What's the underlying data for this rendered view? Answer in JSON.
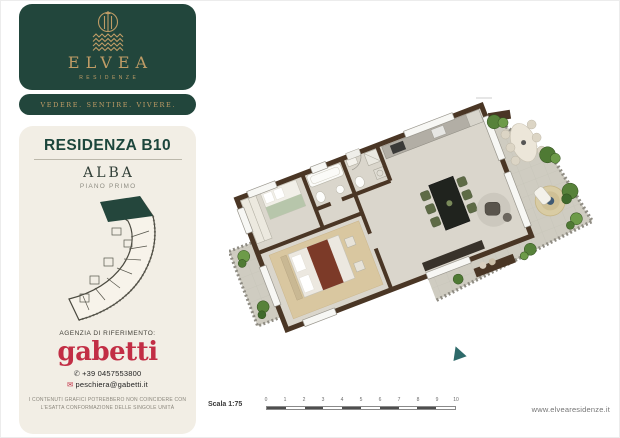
{
  "brand": {
    "name": "ELVEA",
    "subtitle": "RESIDENZE",
    "tagline": "VEDERE. SENTIRE. VIVERE."
  },
  "unit": {
    "title": "RESIDENZA B10",
    "name": "ALBA",
    "floor": "PIANO PRIMO"
  },
  "agency": {
    "label": "AGENZIA DI RIFERIMENTO:",
    "name": "gabetti",
    "phone": "+39 0457553800",
    "email": "peschiera@gabetti.it"
  },
  "disclaimer": {
    "line1": "I CONTENUTI GRAFICI POTREBBERO NON COINCIDERE CON",
    "line2": "L'ESATTA CONFORMAZIONE DELLE SINGOLE UNITÀ"
  },
  "scalebar": {
    "label": "Scala 1:75",
    "ticks": [
      "0",
      "1",
      "2",
      "3",
      "4",
      "5",
      "6",
      "7",
      "8",
      "9",
      "10"
    ]
  },
  "footer": {
    "website": "www.elvearesidenze.it"
  },
  "icons": {
    "phone": "✆",
    "email": "✉"
  },
  "colors": {
    "brand_green": "#22463c",
    "brand_gold": "#bf9c66",
    "panel_cream": "#f2eee5",
    "gabetti_red": "#c22e45",
    "wall_brown": "#4a3625",
    "keyplan_highlight": "#24463c",
    "entry_marker_teal": "#2e6a6a"
  }
}
